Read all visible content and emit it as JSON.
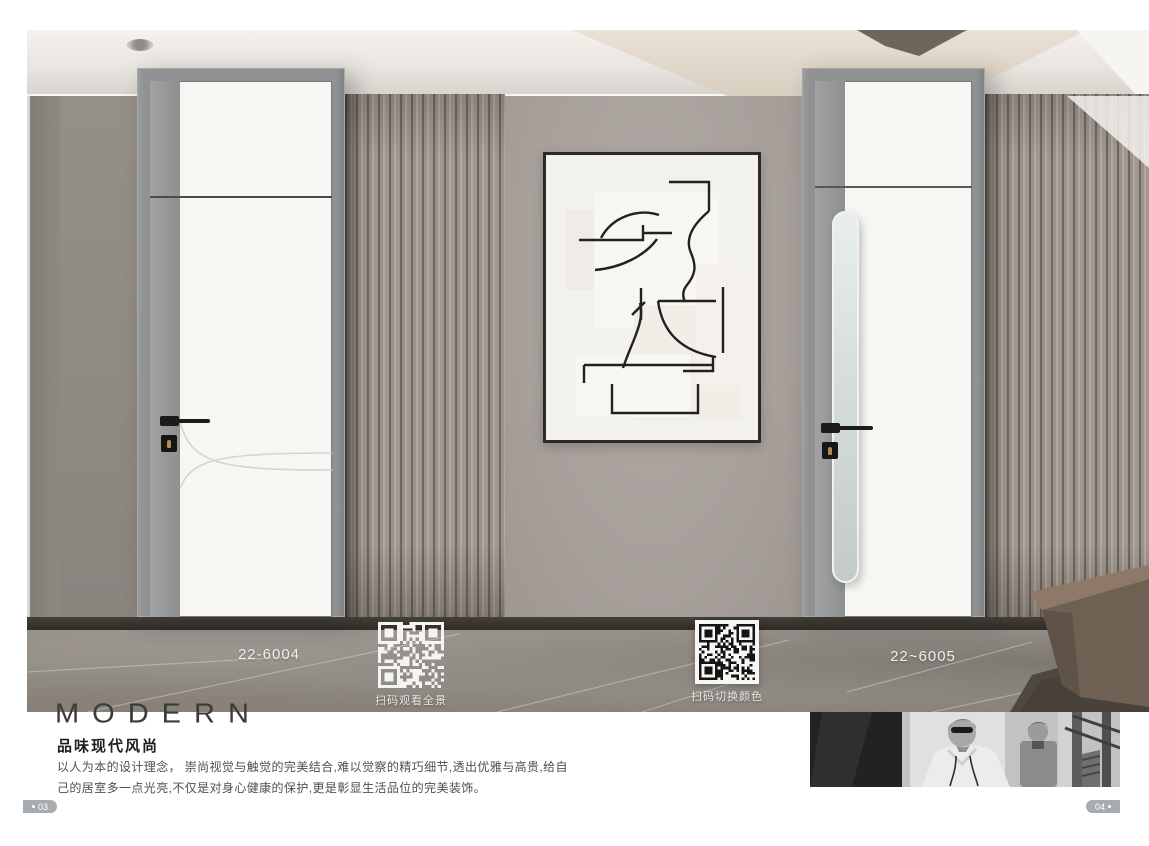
{
  "page": {
    "left_page_number": "03",
    "right_page_number": "04"
  },
  "scene": {
    "left_door": {
      "model": "22-6004"
    },
    "right_door": {
      "model": "22~6005"
    },
    "qr_panorama": {
      "caption": "扫码观看全景"
    },
    "qr_color_switch": {
      "caption": "扫码切换颜色"
    }
  },
  "text_block": {
    "brand_word": "MODERN",
    "heading": "品味现代风尚",
    "body_line1": "以人为本的设计理念， 崇尚视觉与触觉的完美结合,难以觉察的精巧细节,透出优雅与高贵,给自",
    "body_line2": "己的居室多一点光亮,不仅是对身心健康的保护,更是彰显生活品位的完美装饰。"
  },
  "colors": {
    "badge-bg": "#a7acb0",
    "brand-text": "#3b3b3b",
    "heading-text": "#1d1d1d",
    "body-text": "#4f4f4f",
    "floor-label-text": "#f1efec",
    "qr-caption-text": "#e9e7e3",
    "frame-gray": "#8f9193",
    "wall-gray": "#a7a09b"
  }
}
